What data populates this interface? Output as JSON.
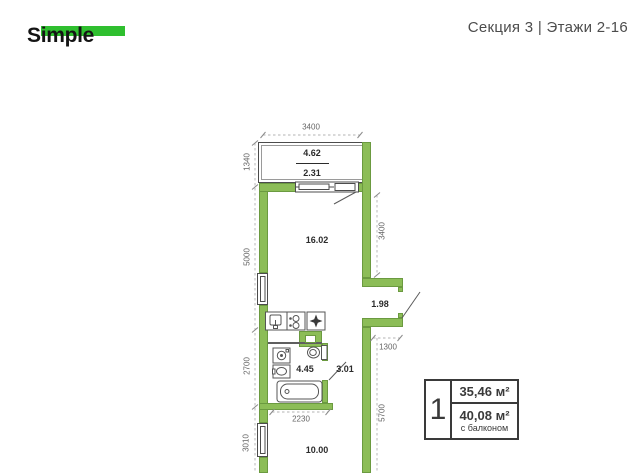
{
  "header": {
    "logo": "Simple",
    "location": "Секция 3 | Этажи 2-16"
  },
  "plan": {
    "areas": {
      "balcony_full": "4.62",
      "balcony_reduced": "2.31",
      "living": "16.02",
      "entry": "1.98",
      "bathroom": "4.45",
      "hall": "3.01",
      "kitchen": "10.00"
    },
    "dimensions": {
      "top_width": "3400",
      "balcony_depth": "1340",
      "living_height": "5000",
      "bathroom_height": "2700",
      "kitchen_height": "3010",
      "living_width_right": "3400",
      "entry_width": "1300",
      "lower_height_right": "5700",
      "bathroom_width": "2230"
    }
  },
  "info_box": {
    "rooms": "1",
    "area_main": "35,46 м²",
    "area_with_balcony": "40,08 м²",
    "area_note": "с балконом"
  },
  "icons": {
    "kitchen_sink": "basin-with-tap",
    "stove": "two-burner-circles",
    "vent": "✦",
    "washing_machine": "drum-circle",
    "bathroom_sink": "oval-basin",
    "toilet": "bowl-with-tank",
    "bathtub": "tub-outline"
  },
  "colors": {
    "wall_fill": "#8cbd57",
    "wall_stroke": "#6b9a40",
    "logo_green": "#2fbf2f",
    "outline_gray": "#4c4c4c",
    "text_dark": "#333333",
    "dim_gray": "#666666"
  }
}
